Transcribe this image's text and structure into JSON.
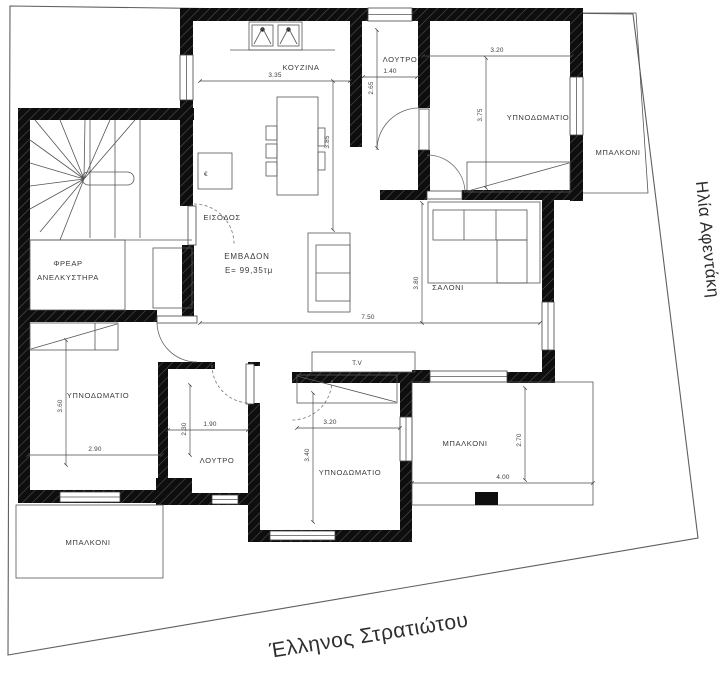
{
  "streets": {
    "bottom": "Έλληνος Στρατιώτου",
    "right": "Ηλία Αφεντάκη"
  },
  "area": {
    "label": "ΕΜΒΑΔΟΝ",
    "value": "E= 99,35τμ"
  },
  "rooms": {
    "kitchen": "ΚΟΥΖΙΝΑ",
    "bath_top": "ΛΟΥΤΡΟ",
    "bedroom_tr": "ΥΠΝΟΔΩΜΑΤΙΟ",
    "balcony_tr": "ΜΠΑΛΚΟΝΙ",
    "elevator_line1": "ΦΡΕΑΡ",
    "elevator_line2": "ΑΝΕΛΚΥΣΤΗΡΑ",
    "entrance": "ΕΙΣΟΔΟΣ",
    "living": "ΣΑΛΟΝΙ",
    "tv": "T.V",
    "bedroom_bl": "ΥΠΝΟΔΩΜΑΤΙΟ",
    "bath_bottom": "ΛΟΥΤΡΟ",
    "bedroom_bc": "ΥΠΝΟΔΩΜΑΤΙΟ",
    "balcony_br": "ΜΠΑΛΚΟΝΙ",
    "balcony_bl": "ΜΠΑΛΚΟΝΙ",
    "appliance": "€"
  },
  "dimensions": {
    "kitchen_w": "3.35",
    "kitchen_h": "3.85",
    "bath_top_w": "1.40",
    "bath_top_h": "2.65",
    "bedroom_tr_w": "3.20",
    "bedroom_tr_h": "3.75",
    "living_w": "7.50",
    "living_h": "3.80",
    "bedroom_bl_w": "2.90",
    "bedroom_bl_h": "3.60",
    "bath_bottom_w": "1.90",
    "bath_bottom_h": "2.30",
    "bedroom_bc_w": "3.20",
    "bedroom_bc_h": "3.40",
    "balcony_br_w": "4.00",
    "balcony_br_h": "2.70"
  },
  "colors": {
    "wall": "#0e0e0e",
    "line": "#555555",
    "background": "#ffffff"
  }
}
